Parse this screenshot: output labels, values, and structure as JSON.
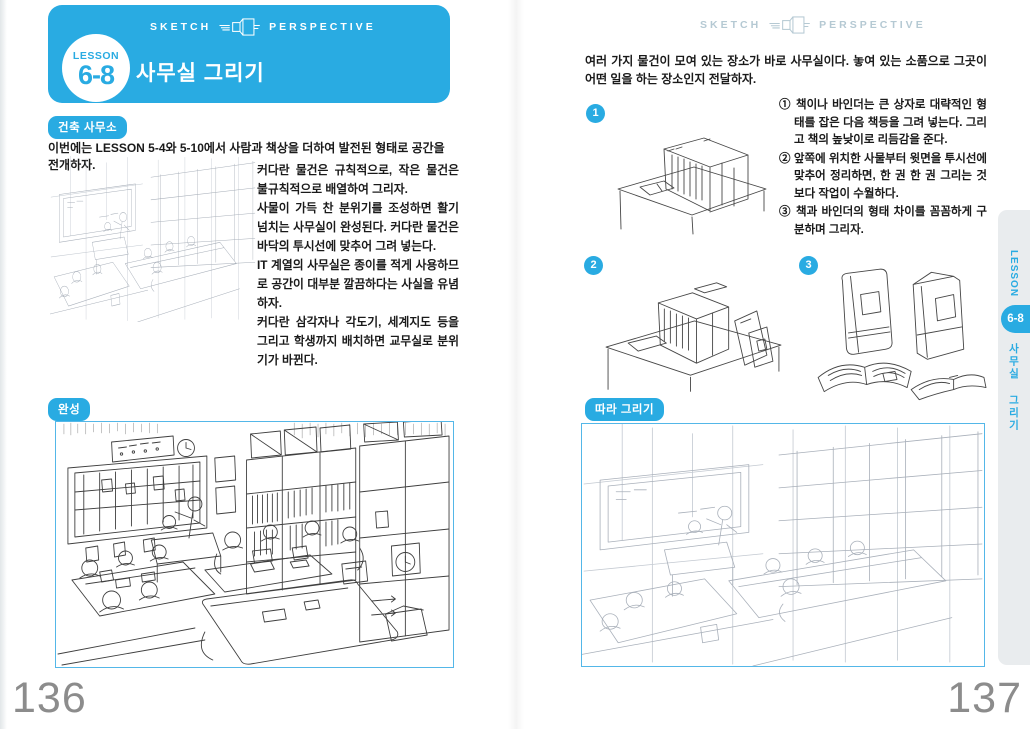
{
  "colors": {
    "accent": "#29abe2",
    "frame_border": "#54b7e8",
    "sidebar_bg": "#e9ecee",
    "page_number_gray": "#8c8c8c",
    "logo_muted": "#b5c9d3"
  },
  "left_page": {
    "page_number": "136",
    "logo": {
      "word_left": "SKETCH",
      "word_right": "PERSPECTIVE"
    },
    "lesson_badge": {
      "label": "LESSON",
      "number": "6-8"
    },
    "title": "사무실 그리기",
    "section_badge": "건축 사무소",
    "intro": "이번에는 LESSON 5-4와 5-10에서 사람과 책상을 더하여 발전된 형태로 공간을 전개하자.",
    "body": [
      "커다란 물건은 규칙적으로, 작은 물건은 불규칙적으로 배열하여 그리자.",
      "사물이 가득 찬 분위기를 조성하면 활기 넘치는 사무실이 완성된다. 커다란 물건은 바닥의 투시선에 맞추어 그려 넣는다.",
      "IT 계열의 사무실은 종이를 적게 사용하므로 공간이 대부분 깔끔하다는 사실을 유념하자.",
      "커다란 삼각자나 각도기, 세계지도 등을 그리고 학생까지 배치하면 교무실로 분위기가 바뀐다."
    ],
    "completed_badge": "완성"
  },
  "right_page": {
    "page_number": "137",
    "logo": {
      "word_left": "SKETCH",
      "word_right": "PERSPECTIVE"
    },
    "intro": "여러 가지 물건이 모여 있는 장소가 바로 사무실이다. 놓여 있는 소품으로 그곳이 어떤 일을 하는 장소인지 전달하자.",
    "step_numbers": [
      "1",
      "2",
      "3"
    ],
    "instructions": [
      "① 책이나 바인더는 큰 상자로 대략적인 형태를 잡은 다음 책등을 그려 넣는다. 그리고 책의 높낮이로 리듬감을 준다.",
      "② 앞쪽에 위치한 사물부터 윗면을 투시선에 맞추어 정리하면, 한 권 한 권 그리는 것보다 작업이 수월하다.",
      "③ 책과 바인더의 형태 차이를 꼼꼼하게 구분하며 그리자."
    ],
    "follow_badge": "따라 그리기",
    "sidebar_tab": {
      "lesson_label": "LESSON",
      "lesson_number": "6-8",
      "title": "사무실 그리기"
    }
  }
}
